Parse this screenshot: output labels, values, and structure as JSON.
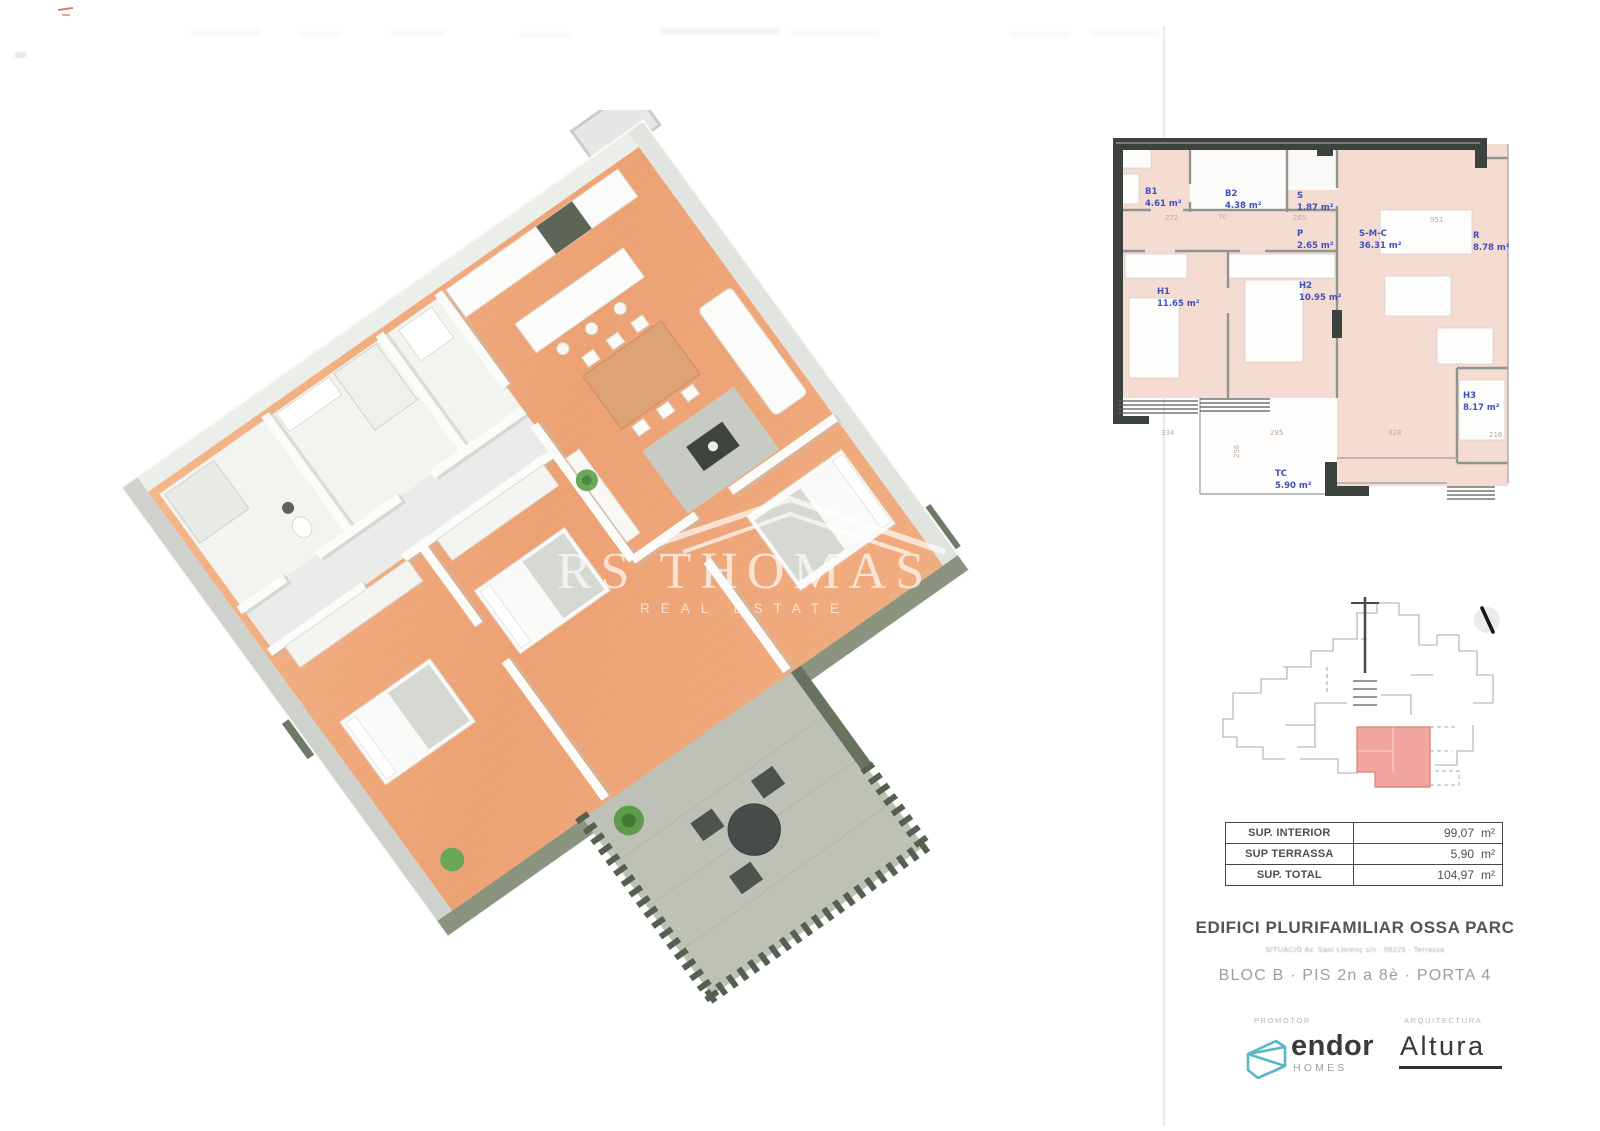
{
  "watermark": {
    "title": "RS THOMAS",
    "subtitle": "REAL ESTATE"
  },
  "plan2d": {
    "rooms": [
      {
        "code": "B1",
        "area": "4.61 m²"
      },
      {
        "code": "B2",
        "area": "4.38 m²"
      },
      {
        "code": "S",
        "area": "1.87 m²"
      },
      {
        "code": "P",
        "area": "2.65 m²"
      },
      {
        "code": "S-M-C",
        "area": "36.31 m²"
      },
      {
        "code": "R",
        "area": "8.78 m²"
      },
      {
        "code": "H1",
        "area": "11.65 m²"
      },
      {
        "code": "H2",
        "area": "10.95 m²"
      },
      {
        "code": "H3",
        "area": "8.17 m²"
      },
      {
        "code": "TC",
        "area": "5.90 m²"
      }
    ],
    "dims": [
      "272",
      "70",
      "265",
      "951",
      "334",
      "285",
      "256",
      "328",
      "216"
    ]
  },
  "areas_table": {
    "unit": "m²",
    "rows": [
      {
        "label": "SUP. INTERIOR",
        "value": "99,07"
      },
      {
        "label": "SUP TERRASSA",
        "value": "5,90"
      },
      {
        "label": "SUP. TOTAL",
        "value": "104,97"
      }
    ]
  },
  "project": {
    "title": "EDIFICI PLURIFAMILIAR OSSA PARC",
    "situacio": "SITUACIÓ      Av. Sant Llorenç s/n  ·  08225  ·  Terrassa",
    "unit_line": "BLOC B  ·  PIS 2n a 8è  ·  PORTA 4"
  },
  "branding": {
    "promotor_label": "PROMOTOR",
    "promotor_name": "endor",
    "promotor_sub": "HOMES",
    "architect_label": "ARQUITECTURA",
    "architect_name": "Altura"
  },
  "colors": {
    "plan_pink": "#f5dcd3",
    "wall_dark": "#3c423c",
    "label_blue": "#4150bb",
    "wood": "#efa97c",
    "terrace_gray": "#bdc1b6",
    "exterior_green_gray": "#75806d",
    "unit_red": "#f29b95",
    "brand_teal": "#57b7c5"
  }
}
